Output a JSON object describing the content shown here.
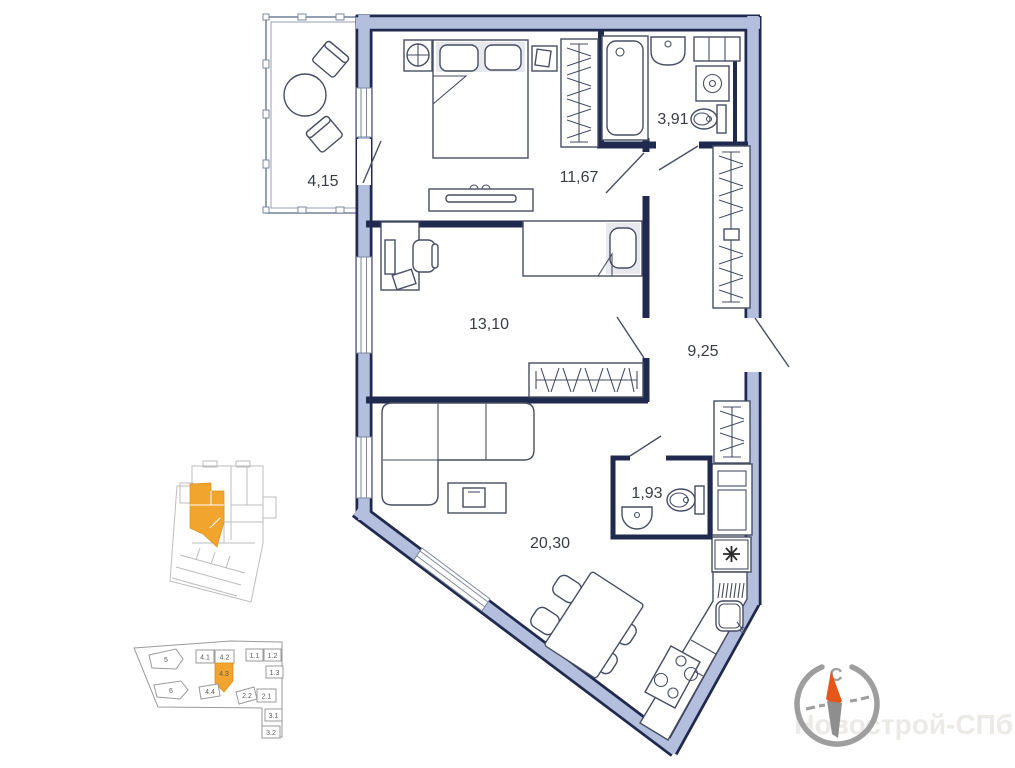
{
  "plan": {
    "rooms": {
      "balcony": {
        "name": "balcony",
        "area": "4,15"
      },
      "bedroom": {
        "name": "bedroom",
        "area": "11,67"
      },
      "bathroom": {
        "name": "bathroom",
        "area": "3,91"
      },
      "bedroom2": {
        "name": "second-room",
        "area": "13,10"
      },
      "hallway": {
        "name": "hallway",
        "area": "9,25"
      },
      "wc": {
        "name": "wc",
        "area": "1,93"
      },
      "living_kitchen": {
        "name": "living-kitchen",
        "area": "20,30"
      }
    }
  },
  "floor_schematic": {
    "units": {
      "u5": "5",
      "u6": "6",
      "u41": "4.1",
      "u42": "4.2",
      "u43": "4.3",
      "u44": "4.4",
      "u11": "1.1",
      "u12": "1.2",
      "u13": "1.3",
      "u22": "2.2",
      "u21": "2.1",
      "u31": "3.1",
      "u32": "3.2"
    },
    "highlighted_unit": "4.3"
  },
  "compass": {
    "north_label": "С"
  },
  "watermark": "Новострой-СПб",
  "colors": {
    "wall_fill": "#b4bfde",
    "wall_outline": "#1f2a4e",
    "furniture_line": "#474e63",
    "highlight_orange": "#f1a42e",
    "compass_orange": "#e4571b",
    "compass_gray": "#9e9e9e",
    "watermark_gray": "#eceae6",
    "label_color": "#383d45"
  }
}
